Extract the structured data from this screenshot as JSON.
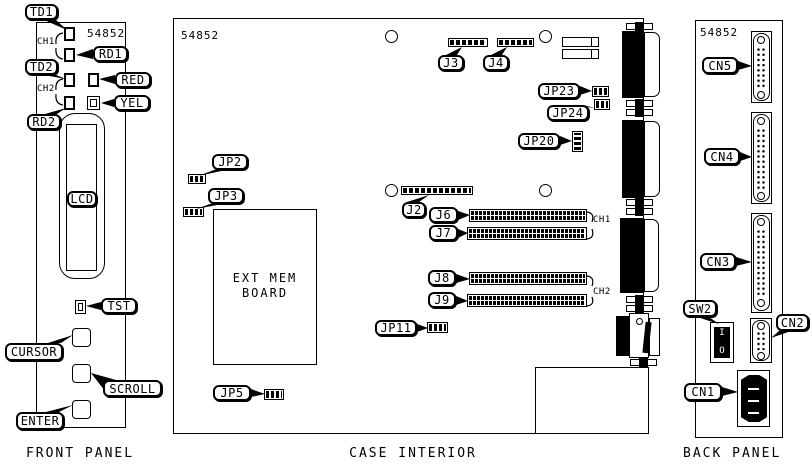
{
  "colors": {
    "ink": "#000000",
    "paper": "#ffffff"
  },
  "front_panel": {
    "model": "54852",
    "caption": "FRONT PANEL",
    "channel_labels": [
      "CH1",
      "CH2"
    ],
    "callouts": {
      "td1": "TD1",
      "rd1": "RD1",
      "td2": "TD2",
      "rd2": "RD2",
      "red": "RED",
      "yel": "YEL",
      "lcd": "LCD",
      "tst": "TST",
      "cursor": "CURSOR",
      "scroll": "SCROLL",
      "enter": "ENTER"
    }
  },
  "case_interior": {
    "model": "54852",
    "caption": "CASE INTERIOR",
    "channel_labels": [
      "CH1",
      "CH2"
    ],
    "ext_mem_board": [
      "EXT MEM",
      "BOARD"
    ],
    "callouts": {
      "j3": "J3",
      "j4": "J4",
      "jp23": "JP23",
      "jp24": "JP24",
      "jp20": "JP20",
      "j2": "J2",
      "j6": "J6",
      "j7": "J7",
      "j8": "J8",
      "j9": "J9",
      "jp11": "JP11",
      "jp2": "JP2",
      "jp3": "JP3",
      "jp5": "JP5"
    }
  },
  "back_panel": {
    "model": "54852",
    "caption": "BACK PANEL",
    "callouts": {
      "cn5": "CN5",
      "cn4": "CN4",
      "cn3": "CN3",
      "sw2": "SW2",
      "cn2": "CN2",
      "cn1": "CN1"
    },
    "power_switch": {
      "on": "I",
      "off": "O"
    }
  }
}
